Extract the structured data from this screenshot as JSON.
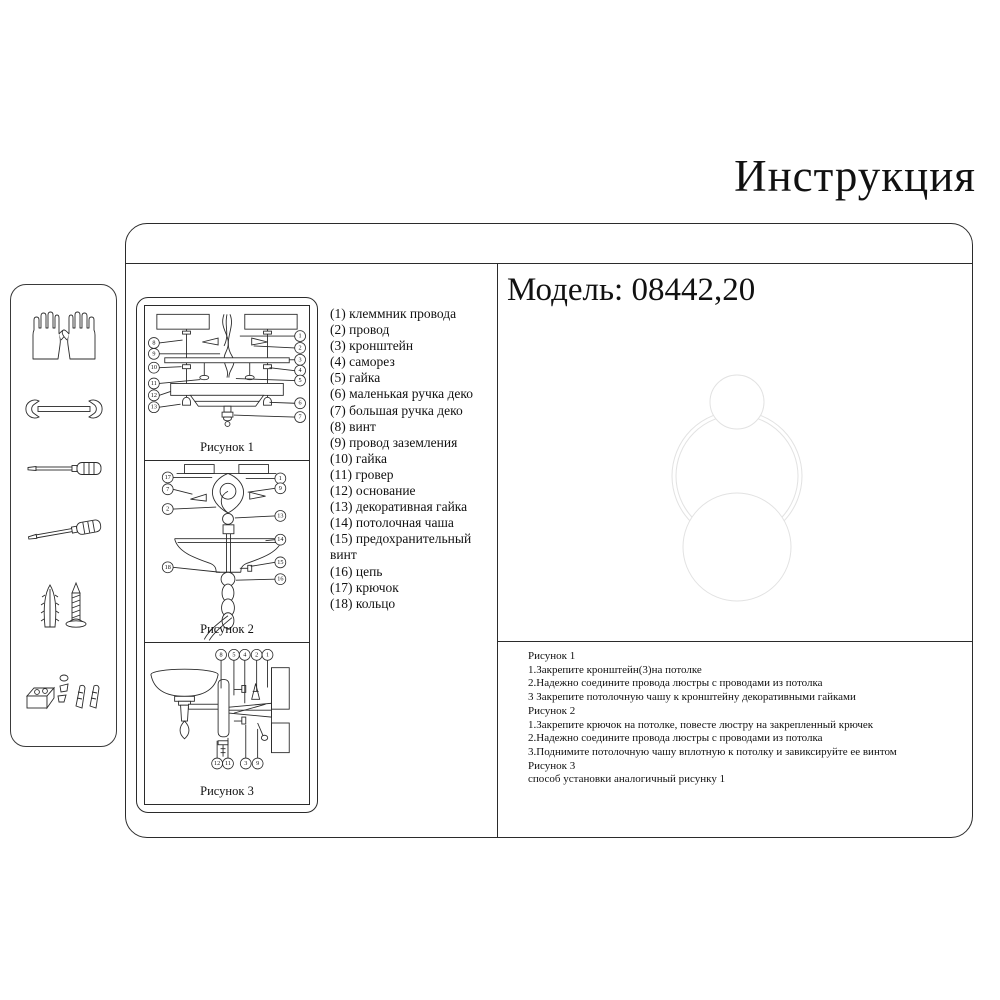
{
  "title": "Инструкция",
  "model": {
    "label": "Модель: 08442,20"
  },
  "sidebar": {
    "tools": [
      "gloves",
      "wrench",
      "screwdriver-flat",
      "screwdriver-angled",
      "wall-anchor-and-screw",
      "fasteners-set"
    ]
  },
  "figures": {
    "fig1": {
      "caption": "Рисунок 1",
      "callouts_left": [
        "8",
        "9",
        "10",
        "11",
        "12",
        "13"
      ],
      "callouts_right": [
        "1",
        "2",
        "3",
        "4",
        "5",
        "6",
        "7"
      ]
    },
    "fig2": {
      "caption": "Рисунок 2",
      "callouts_left": [
        "17",
        "7",
        "2",
        "18"
      ],
      "callouts_right": [
        "1",
        "9",
        "13",
        "14",
        "15",
        "16"
      ]
    },
    "fig3": {
      "caption": "Рисунок 3",
      "callouts_top": [
        "8",
        "5",
        "4",
        "2",
        "1"
      ],
      "callouts_bottom": [
        "12",
        "11",
        "3",
        "9"
      ]
    }
  },
  "parts": {
    "items": [
      "(1) клеммник провода",
      "(2) провод",
      "(3) кронштейн",
      "(4) саморез",
      "(5) гайка",
      "(6) маленькая ручка деко",
      "(7) большая ручка деко",
      "(8) винт",
      "(9) провод заземления",
      "(10) гайка",
      "(11) гровер",
      "(12) основание",
      "(13) декоративная гайка",
      "(14) потолочная чаша",
      "(15) предохранительный винт",
      "(16) цепь",
      "(17) крючок",
      "(18) кольцо"
    ]
  },
  "instructions": {
    "lines": [
      "Рисунок 1",
      "1.Закрепите кронштейн(3)на потолке",
      "2.Надежно соедините провода люстры с проводами из потолка",
      "3 Закрепите потолочную чашу к кронштейну декоративными гайками",
      "Рисунок 2",
      "1.Закрепите крючок на потолке, повесте люстру на закрепленный крючек",
      "2.Надежно соедините провода люстры с проводами из потолка",
      "3.Поднимите потолочную чашу вплотную к потолку и завиксируйте ее винтом",
      "Рисунок 3",
      "способ установки аналогичный рисунку 1"
    ]
  },
  "colors": {
    "line": "#2b2b2b",
    "watermark": "#e2e2e2"
  }
}
